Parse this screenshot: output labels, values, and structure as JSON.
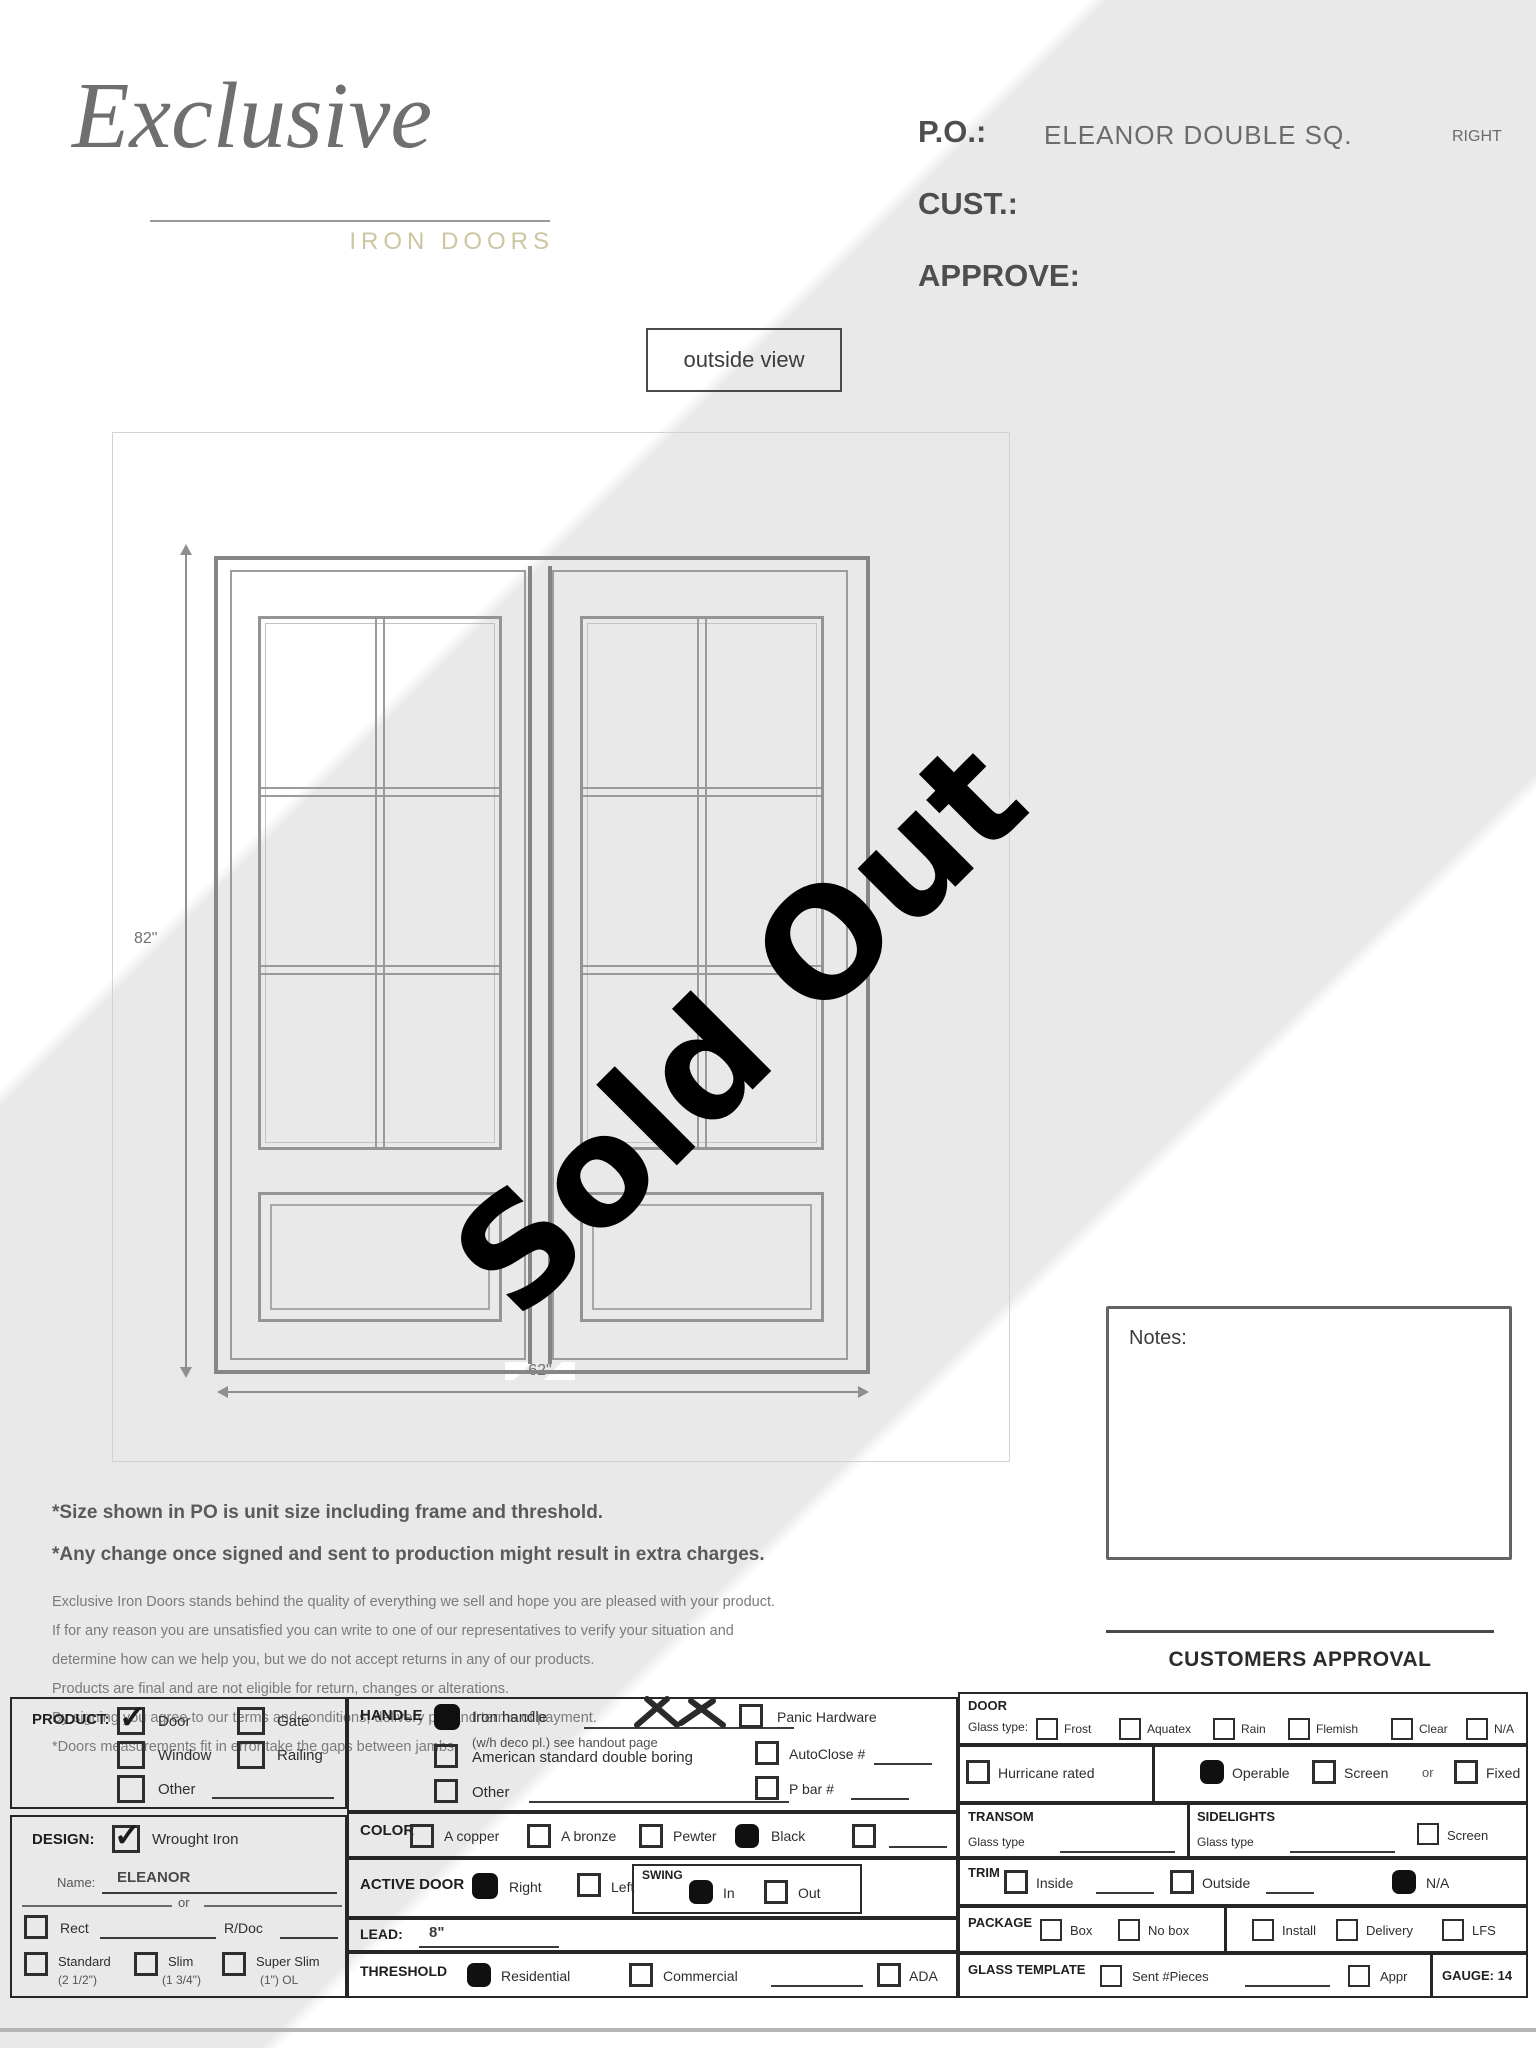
{
  "header": {
    "logo_script": "Exclusive",
    "logo_subtitle": "IRON DOORS",
    "po_label": "P.O.:",
    "po_value": "ELEANOR DOUBLE SQ.",
    "po_suffix": "RIGHT",
    "cust_label": "CUST.:",
    "approve_label": "APPROVE:"
  },
  "view_label": "outside view",
  "watermark": "Sold Out",
  "drawing": {
    "height_dim": "82\"",
    "width_dim": "62\""
  },
  "notes_label": "Notes:",
  "approval_label": "CUSTOMERS APPROVAL",
  "disclaimer": {
    "line1": "*Size shown in PO is unit size including frame and threshold.",
    "line2": "*Any change once signed and sent to production might result in extra charges.",
    "p": [
      "Exclusive Iron Doors stands behind the quality of everything we sell and hope you are pleased with your product.",
      "If for any reason you are unsatisfied you can write to one of our representatives to verify your situation and",
      "determine how can we help you, but we do not accept returns in any of our products.",
      "Products are final and are not eligible for return, changes or alterations.",
      "By signing you agree to our terms and conditions, delivery pdf and terms of payment.",
      "*Doors measurements fit in error take the gaps between jambs."
    ]
  },
  "form": {
    "product": {
      "title": "PRODUCT:",
      "options": [
        {
          "label": "Door",
          "checked": true
        },
        {
          "label": "Gate",
          "checked": false
        },
        {
          "label": "Window",
          "checked": false
        },
        {
          "label": "Railing",
          "checked": false
        },
        {
          "label": "Other",
          "checked": false
        }
      ]
    },
    "design": {
      "title": "DESIGN:",
      "wrought_label": "Wrought Iron",
      "wrought_checked": true,
      "name_label": "Name:",
      "name_value": "ELEANOR",
      "or_label": "or",
      "rect_label": "Rect",
      "rdoc_label": "R/Doc",
      "frames": [
        {
          "label": "Standard",
          "sub": "(2 1/2\")"
        },
        {
          "label": "Slim",
          "sub": "(1 3/4\")"
        },
        {
          "label": "Super Slim",
          "sub": "(1\") OL"
        }
      ]
    },
    "handle": {
      "title": "HANDLE",
      "iron_label": "Iron handle",
      "iron_checked": true,
      "iron_note": "(w/h deco pl.) see handout page",
      "american_label": "American standard double boring",
      "other_label": "Other",
      "panic_label": "Panic Hardware",
      "autoclose_label": "AutoClose #",
      "pbar_label": "P bar #"
    },
    "color": {
      "title": "COLOR",
      "options": [
        {
          "label": "A copper",
          "checked": false
        },
        {
          "label": "A bronze",
          "checked": false
        },
        {
          "label": "Pewter",
          "checked": false
        },
        {
          "label": "Black",
          "checked": true
        }
      ]
    },
    "active_door": {
      "title": "ACTIVE DOOR",
      "right_label": "Right",
      "right_checked": true,
      "left_label": "Left",
      "swing_title": "SWING",
      "in_label": "In",
      "in_checked": true,
      "out_label": "Out"
    },
    "lead": {
      "title": "LEAD:",
      "value": "8\""
    },
    "threshold": {
      "title": "THRESHOLD",
      "residential_label": "Residential",
      "residential_checked": true,
      "commercial_label": "Commercial",
      "ada_label": "ADA"
    },
    "door": {
      "title": "DOOR",
      "glass_label": "Glass type:",
      "options": [
        "Frost",
        "Aquatex",
        "Rain",
        "Flemish",
        "Clear",
        "N/A"
      ]
    },
    "hurricane_label": "Hurricane rated",
    "operable": {
      "operable_label": "Operable",
      "operable_checked": true,
      "screen_label": "Screen",
      "or_label": "or",
      "fixed_label": "Fixed"
    },
    "transom": {
      "title": "TRANSOM",
      "glass_label": "Glass type"
    },
    "sidelights": {
      "title": "SIDELIGHTS",
      "glass_label": "Glass type",
      "screen_label": "Screen"
    },
    "trim": {
      "title": "TRIM",
      "inside_label": "Inside",
      "outside_label": "Outside",
      "na_label": "N/A",
      "na_checked": true
    },
    "package": {
      "title": "PACKAGE",
      "box_label": "Box",
      "nobox_label": "No box",
      "install_label": "Install",
      "delivery_label": "Delivery",
      "lfs_label": "LFS"
    },
    "glass_template": {
      "title": "GLASS TEMPLATE",
      "sent_label": "Sent #Pieces",
      "appr_label": "Appr",
      "gauge_label": "GAUGE: 14"
    }
  }
}
